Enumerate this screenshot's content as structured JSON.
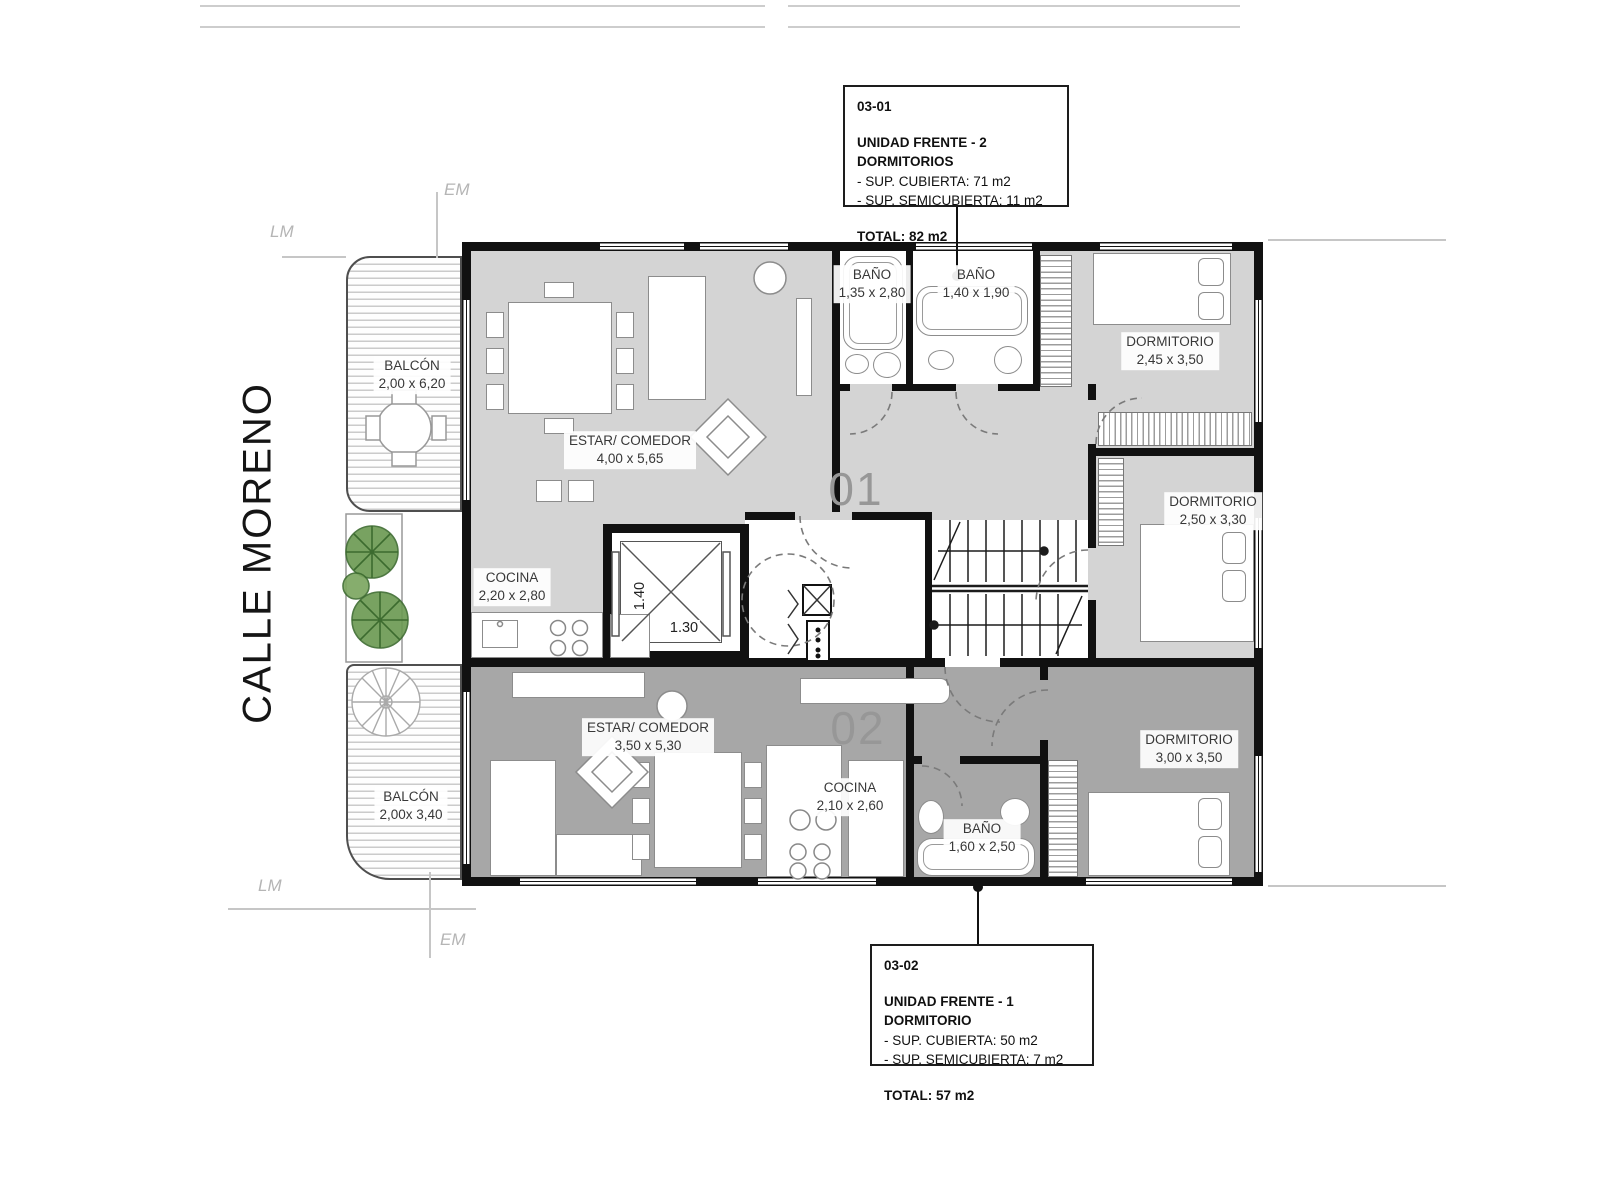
{
  "street_label": "CALLE MORENO",
  "boundary_labels": {
    "lm": "LM",
    "em": "EM"
  },
  "info_boxes": [
    {
      "code": "03-01",
      "title": "UNIDAD FRENTE - 2 DORMITORIOS",
      "line1": "- SUP. CUBIERTA: 71 m2",
      "line2": "- SUP. SEMICUBIERTA: 11 m2",
      "total": "TOTAL: 82 m2"
    },
    {
      "code": "03-02",
      "title": "UNIDAD FRENTE - 1 DORMITORIO",
      "line1": "- SUP. CUBIERTA: 50 m2",
      "line2": "- SUP. SEMICUBIERTA: 7 m2",
      "total": "TOTAL: 57 m2"
    }
  ],
  "unit_numbers": {
    "upper": "01",
    "lower": "02"
  },
  "elevator": {
    "width": "1.40",
    "depth": "1.30"
  },
  "rooms": {
    "balcon1": {
      "name": "BALCÓN",
      "dims": "2,00 x 6,20"
    },
    "estar1": {
      "name": "ESTAR/ COMEDOR",
      "dims": "4,00 x 5,65"
    },
    "cocina1": {
      "name": "COCINA",
      "dims": "2,20 x 2,80"
    },
    "bano1": {
      "name": "BAÑO",
      "dims": "1,35 x 2,80"
    },
    "bano2": {
      "name": "BAÑO",
      "dims": "1,40 x 1,90"
    },
    "dorm1": {
      "name": "DORMITORIO",
      "dims": "2,45 x 3,50"
    },
    "dorm2": {
      "name": "DORMITORIO",
      "dims": "2,50 x 3,30"
    },
    "balcon2": {
      "name": "BALCÓN",
      "dims": "2,00x 3,40"
    },
    "estar2": {
      "name": "ESTAR/ COMEDOR",
      "dims": "3,50 x 5,30"
    },
    "cocina2": {
      "name": "COCINA",
      "dims": "2,10 x 2,60"
    },
    "bano3": {
      "name": "BAÑO",
      "dims": "1,60 x 2,50"
    },
    "dorm3": {
      "name": "DORMITORIO",
      "dims": "3,00 x 3,50"
    }
  },
  "colors": {
    "wall": "#111111",
    "floor_unit_01": "#d4d4d4",
    "floor_unit_02": "#a7a7a7",
    "label_text": "#383838",
    "unit_number": "#979797",
    "plant_green": "#6a9950"
  }
}
